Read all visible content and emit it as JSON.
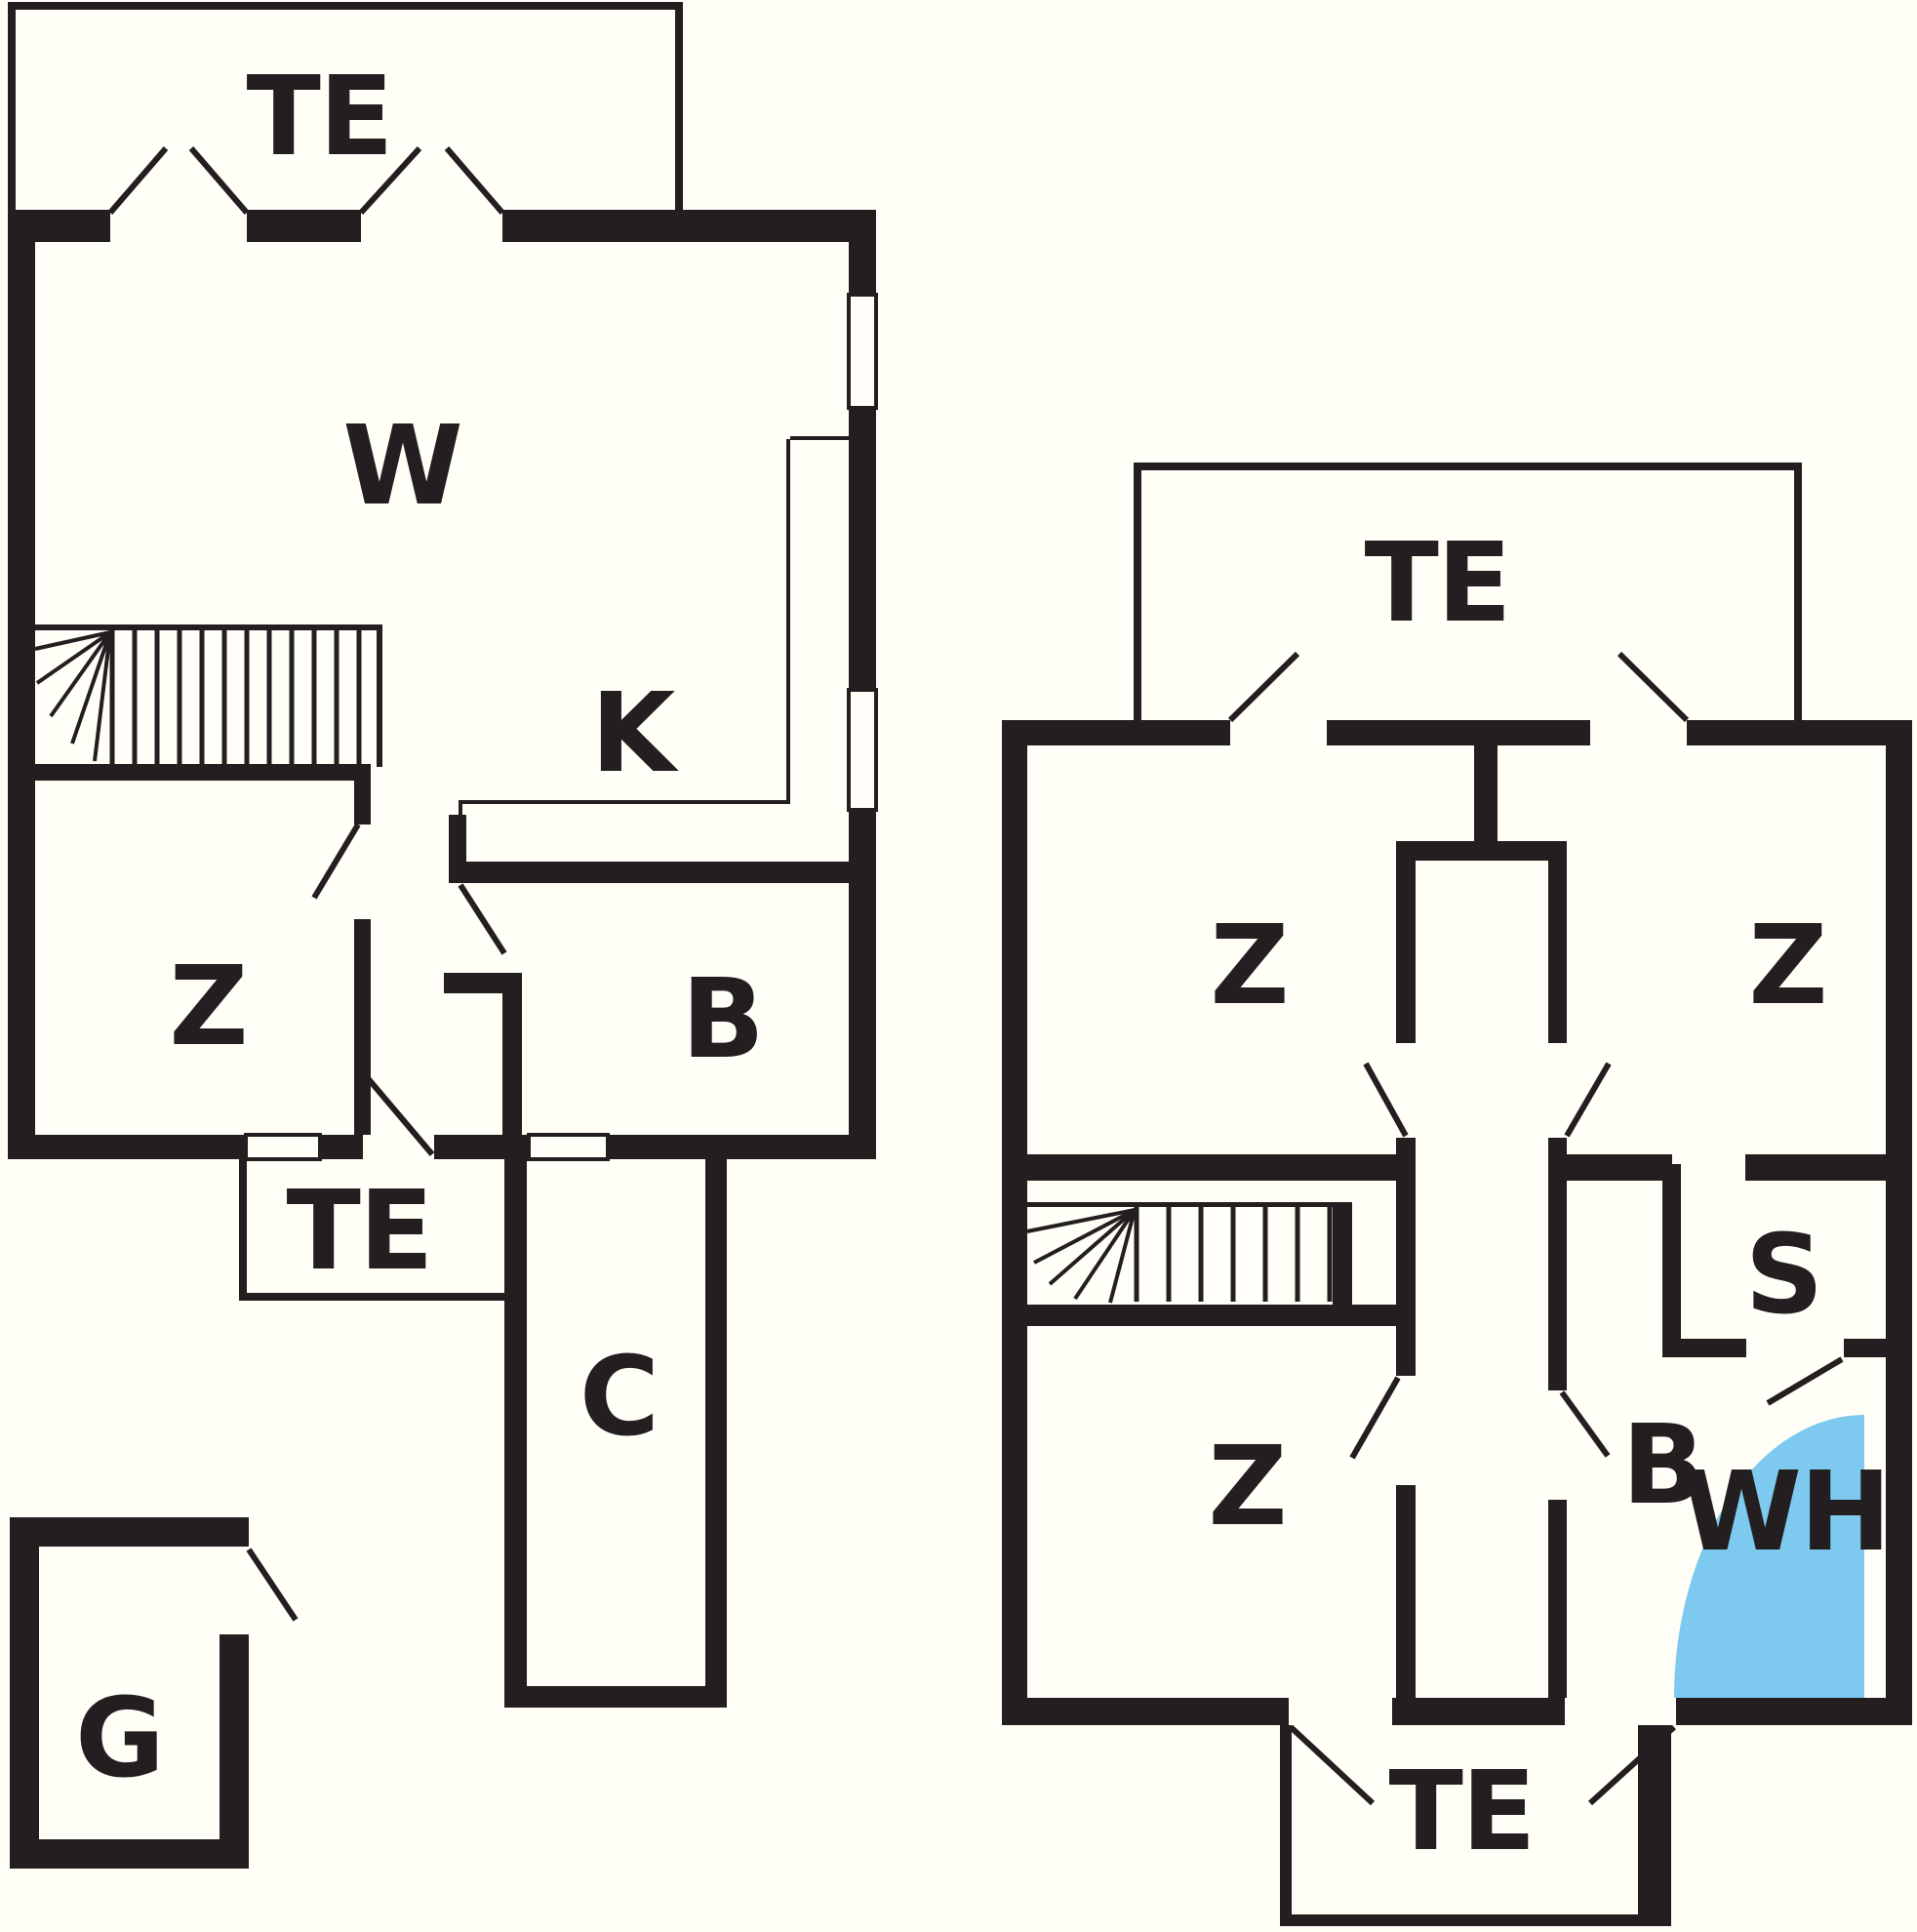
{
  "colors": {
    "ink": "#231f20",
    "background": "#fffef7",
    "whirlpool_blue": "#7dc9ef"
  },
  "plan_left": {
    "room_labels": {
      "te_top": "TE",
      "w": "W",
      "k": "K",
      "z": "Z",
      "b": "B",
      "te_mid": "TE",
      "c": "C",
      "g": "G"
    }
  },
  "plan_right": {
    "room_labels": {
      "te_top": "TE",
      "z_top_left": "Z",
      "z_top_right": "Z",
      "s": "S",
      "z_bottom": "Z",
      "b": "B",
      "wh": "WH",
      "te_bottom": "TE"
    }
  }
}
